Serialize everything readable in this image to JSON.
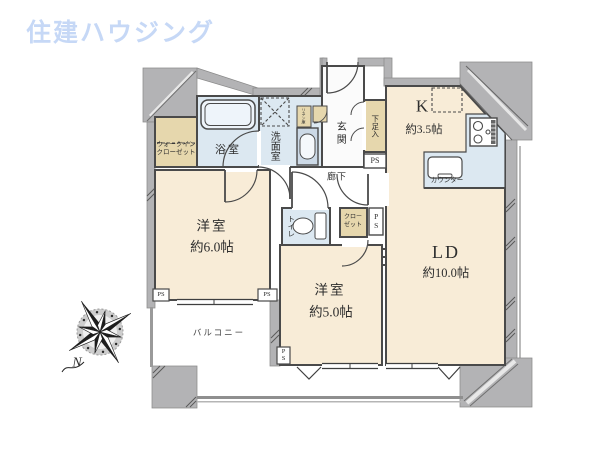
{
  "brand": {
    "logo_text": "住建ハウジング"
  },
  "floor_plan": {
    "rooms": {
      "living_dining": {
        "name": "LD",
        "size": "約10.0帖"
      },
      "kitchen": {
        "name": "K",
        "size": "約3.5帖"
      },
      "bedroom_west_6": {
        "name": "洋室",
        "size": "約6.0帖"
      },
      "bedroom_west_5": {
        "name": "洋室",
        "size": "約5.0帖"
      },
      "bathroom": {
        "name": "浴室"
      },
      "washroom": {
        "name": "洗面室"
      },
      "entrance": {
        "name": "玄関"
      },
      "hallway": {
        "name": "廊下"
      },
      "toilet": {
        "name": "トイレ"
      },
      "walk_in_closet": {
        "name_line1": "ウォークイン",
        "name_line2": "クローゼット"
      },
      "closet": {
        "name_line1": "クロー",
        "name_line2": "ゼット"
      },
      "shoe_cabinet": {
        "name": "下足入"
      },
      "linen_cabinet": {
        "name": "リネン庫"
      },
      "balcony": {
        "name": "バルコニー"
      },
      "counter": {
        "name": "カウンター"
      }
    },
    "pipe_space_label": "PS",
    "compass_north_label": "N",
    "colors": {
      "room_cream": "#f8ecd7",
      "cabinet_tan": "#e6d7ad",
      "wet_area_blue": "#dce8f1",
      "wall_gray": "#b3b3b5",
      "outline": "#4a4a4a",
      "logo_blue": "#c6d8f6"
    }
  }
}
